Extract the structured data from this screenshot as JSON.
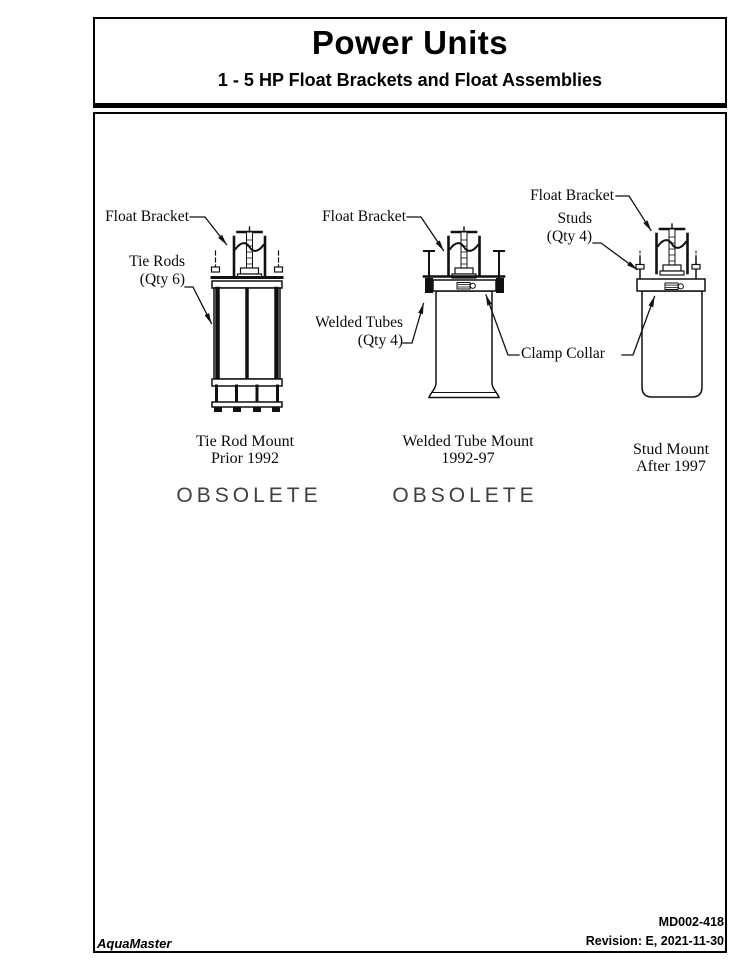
{
  "header": {
    "title": "Power Units",
    "subtitle": "1 - 5 HP Float Brackets and Float Assemblies"
  },
  "diagrams": [
    {
      "name": "Tie Rod Mount",
      "caption_line1": "Tie Rod Mount",
      "caption_line2": "Prior 1992",
      "status": "OBSOLETE",
      "callouts": {
        "float_bracket": "Float Bracket",
        "tie_rods": "Tie Rods\n(Qty 6)"
      }
    },
    {
      "name": "Welded Tube Mount",
      "caption_line1": "Welded Tube Mount",
      "caption_line2": "1992-97",
      "status": "OBSOLETE",
      "callouts": {
        "float_bracket": "Float Bracket",
        "welded_tubes": "Welded Tubes\n(Qty 4)"
      }
    },
    {
      "name": "Stud Mount",
      "caption_line1": "Stud Mount",
      "caption_line2": "After 1997",
      "status": "",
      "callouts": {
        "float_bracket": "Float Bracket",
        "studs": "Studs\n(Qty 4)"
      }
    }
  ],
  "shared_callouts": {
    "clamp_collar": "Clamp Collar"
  },
  "footer": {
    "brand": "AquaMaster",
    "doc_number": "MD002-418",
    "revision": "Revision: E, 2021-11-30"
  },
  "colors": {
    "ink": "#000000",
    "obsolete": "#3f3f3f"
  }
}
